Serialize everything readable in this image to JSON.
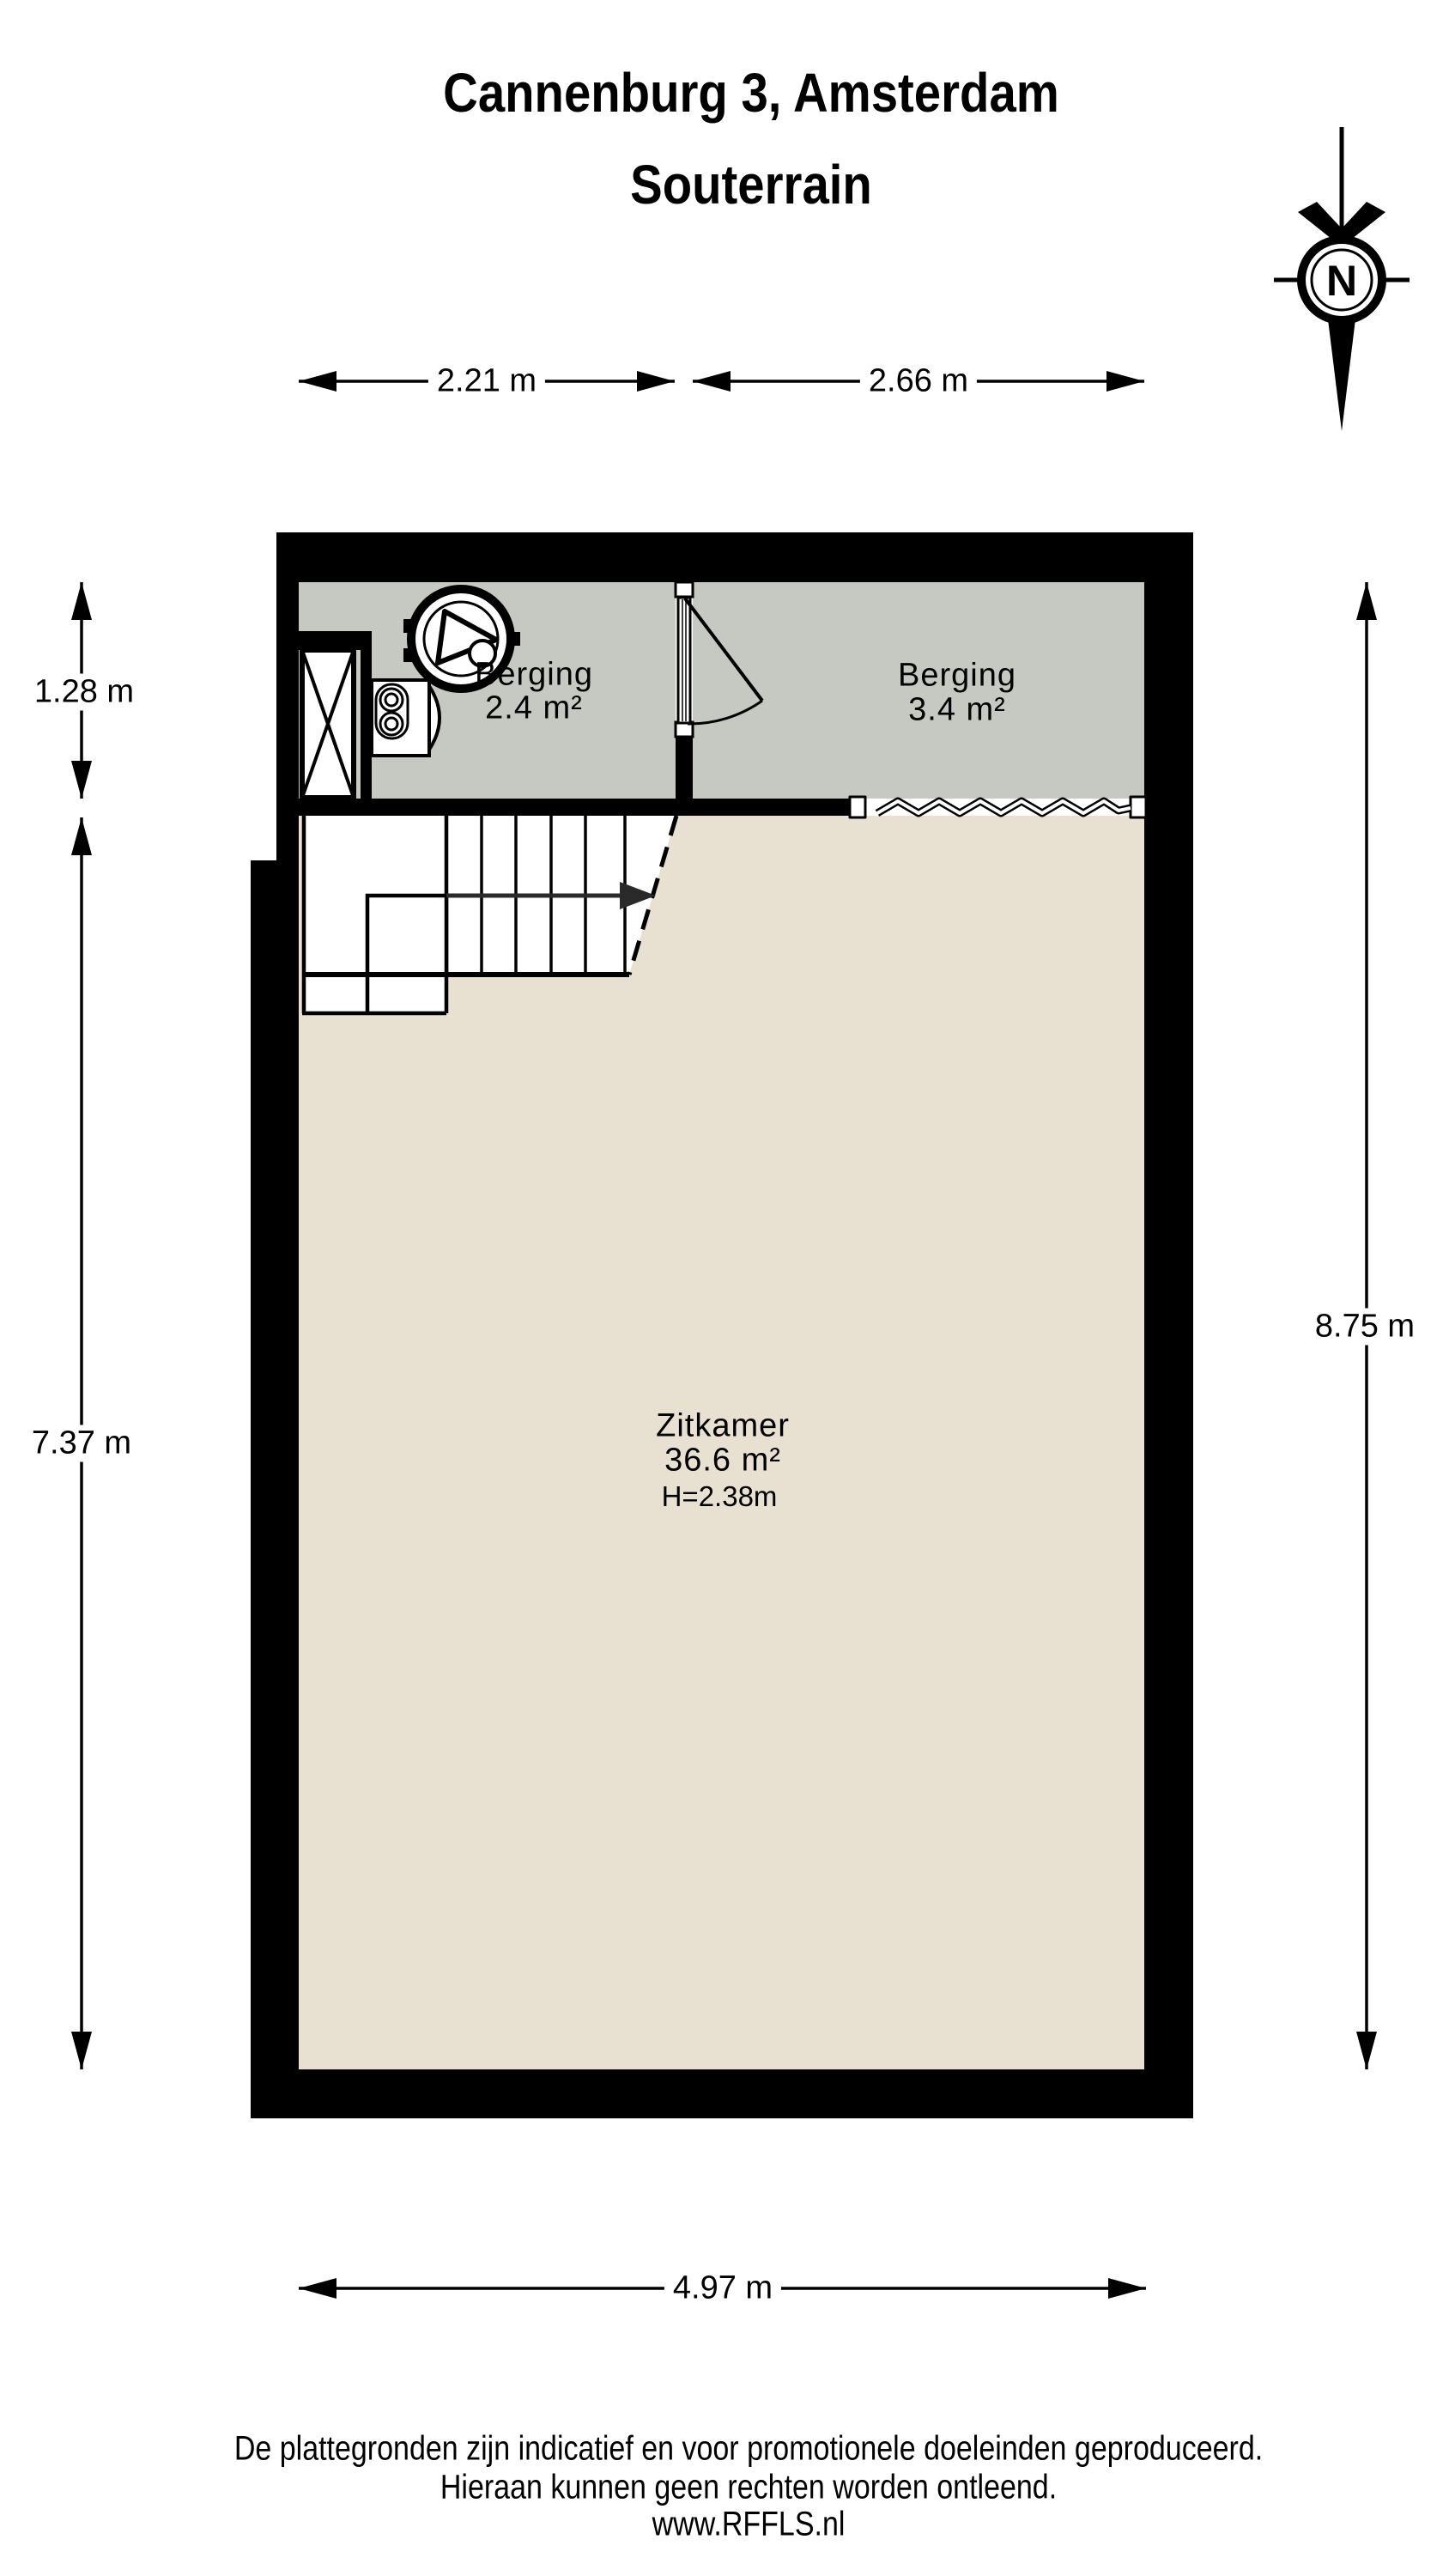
{
  "title": {
    "line1": "Cannenburg 3, Amsterdam",
    "line2": "Souterrain"
  },
  "compass": {
    "label": "N"
  },
  "dimensions": {
    "berging1_width": "2.21 m",
    "berging2_width": "2.66 m",
    "berging_depth": "1.28 m",
    "zitkamer_depth": "7.37 m",
    "right_total_depth": "8.75 m",
    "zitkamer_width": "4.97 m"
  },
  "rooms": {
    "berging1": {
      "name": "Berging",
      "area": "2.4 m²"
    },
    "berging2": {
      "name": "Berging",
      "area": "3.4 m²"
    },
    "zitkamer": {
      "name": "Zitkamer",
      "area": "36.6 m²",
      "ceiling_height": "H=2.38m"
    }
  },
  "footer": {
    "line1": "De plattegronden zijn indicatief en voor promotionele doeleinden geproduceerd.",
    "line2": "Hieraan kunnen geen rechten worden ontleend.",
    "line3": "www.RFFLS.nl"
  },
  "colors": {
    "wall": "#000000",
    "berging_floor": "#c6c9c1",
    "zitkamer_floor": "#e8e0d1",
    "line": "#000000"
  }
}
